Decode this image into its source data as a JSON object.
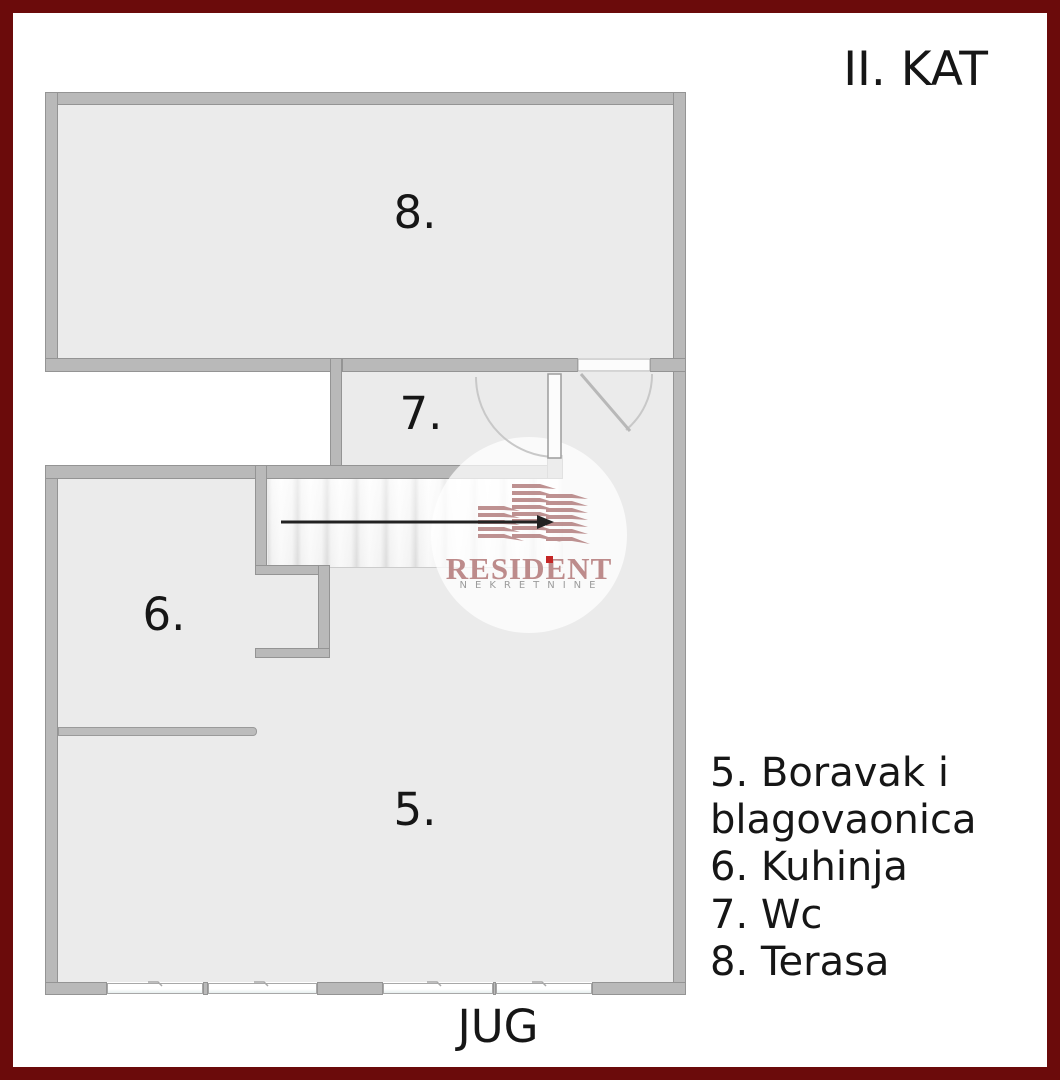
{
  "title": "II. KAT",
  "orientation_label": "JUG",
  "rooms": [
    {
      "number": "5.",
      "name": "Boravak i blagovaonica"
    },
    {
      "number": "6.",
      "name": "Kuhinja"
    },
    {
      "number": "7.",
      "name": "Wc"
    },
    {
      "number": "8.",
      "name": "Terasa"
    }
  ],
  "legend": {
    "items": [
      "5. Boravak i blagovaonica",
      "6. Kuhinja",
      "7. Wc",
      "8. Terasa"
    ]
  },
  "watermark": {
    "brand": "RESIDENT",
    "subtitle": "NEKRETNINE"
  },
  "colors": {
    "frame": "#6b0b0b",
    "wall": "#b9b9b9",
    "wall_edge": "#949494",
    "floor": "#ebebeb",
    "stairs": "#f6f6f6",
    "rose": "#b37f7f",
    "rose_text": "#bd8b8b",
    "ink": "#161616",
    "sub_gray": "#9b9b9b",
    "dot_red": "#c52626"
  }
}
